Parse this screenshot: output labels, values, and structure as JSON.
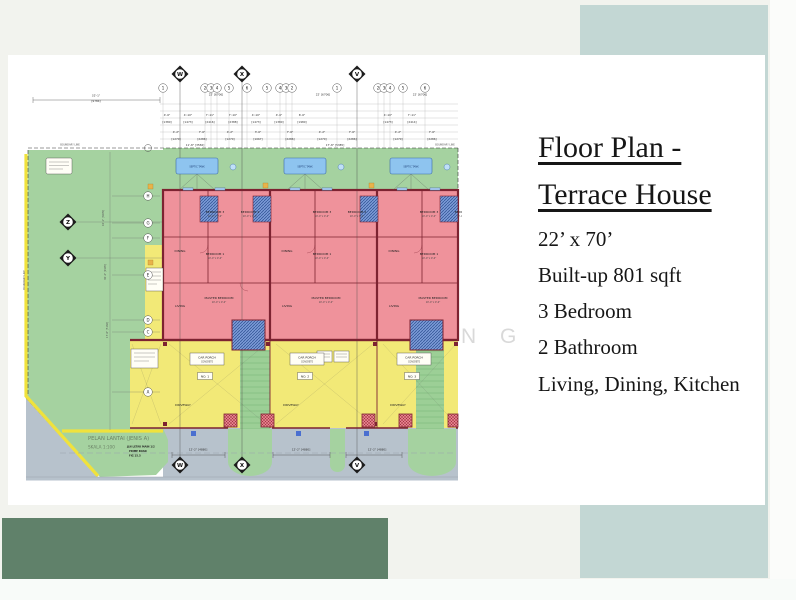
{
  "page": {
    "background": "#f2f3ee",
    "card_color": "#ffffff",
    "accent_band_color": "#c3d7d4",
    "bottom_block_color": "#60816a",
    "watermark_letters": [
      "N",
      "G"
    ]
  },
  "info_panel": {
    "title_line1": "Floor Plan -",
    "title_line2": "Terrace House",
    "specs": [
      "22’ x 70’",
      "Built-up 801 sqft",
      "3 Bedroom",
      "2 Bathroom",
      "Living, Dining, Kitchen"
    ]
  },
  "floor_plan": {
    "drawing_title": "PELAN LANTAI (JENIS A)",
    "drawing_scale": "SKALA 1:100",
    "drawing_notes": [
      "JLN LETAK MAIN 1/2",
      "PRIME ROAD",
      "FIG 15.5"
    ],
    "axis_top": [
      "W",
      "X",
      "V"
    ],
    "axis_side": [
      "Z",
      "Y"
    ],
    "grid_numbers": [
      "1",
      "2",
      "3",
      "4",
      "5",
      "6",
      "5",
      "4",
      "3",
      "2",
      "1",
      "2",
      "3",
      "4",
      "5",
      "6"
    ],
    "grid_row_letters": [
      "H",
      "G",
      "F",
      "E",
      "D",
      "C",
      "A"
    ],
    "labels": {
      "bedroom1": "BEDROOM 1",
      "bedroom2": "BEDROOM 2",
      "bedroom3": "BEDROOM 3",
      "master_bedroom": "MASTER BEDROOM",
      "living": "LIVING",
      "dining": "DINING",
      "room_size": "10'-0\" x 9'-0\"",
      "car_porch": "CAR PORCH",
      "car_porch_sub": "CONCRETE",
      "driveway": "DRIVEWAY",
      "septic_tank": "SEPTIC TANK",
      "boundary_line": "BOUNDARY LINE",
      "unit_nos": [
        "NO. 1",
        "NO. 2",
        "NO. 3"
      ]
    },
    "dims": {
      "overall_ft": "32'-1\"",
      "overall_mm": "[9784]",
      "unit_width": "22' [6706]",
      "road_dim": "12'-2\" [4880]",
      "yard": [
        "10'-1\" [3070]",
        "30'-2\" [9195]",
        "17'-0\" [5182]"
      ]
    },
    "colors": {
      "yard_green": "#a5d2a0",
      "house_pink": "#ef929b",
      "porch_yellow": "#f2e977",
      "road_gray": "#b7c2cc",
      "wall_red": "#7d2331",
      "tank_blue": "#8ec4ef",
      "bath_blue": "#7b9ad6"
    },
    "layout": {
      "top_bubbles_x": [
        163,
        205,
        211,
        217,
        229,
        247,
        267,
        280,
        286,
        292,
        337,
        378,
        384,
        390,
        403,
        425
      ],
      "left_bubbles_y": [
        196,
        223,
        238,
        275,
        320,
        332,
        392
      ],
      "lattice_y": [
        104,
        111,
        118,
        125,
        132,
        139
      ],
      "dim_rows": [
        {
          "y": 116,
          "x": [
            167,
            188,
            210,
            233,
            256,
            279,
            302,
            388,
            412
          ],
          "t": [
            "4'-6\"",
            "4'-10\"",
            "7'-11\"",
            "7'-10\"",
            "4'-10\"",
            "4'-6\"",
            "6'-6\"",
            "4'-10\"",
            "7'-11\""
          ]
        },
        {
          "y": 123,
          "x": [
            167,
            188,
            210,
            233,
            256,
            279,
            302,
            388,
            412
          ],
          "t": [
            "[1380]",
            "[1473]",
            "[2416]",
            "[2388]",
            "[1473]",
            "[1380]",
            "[1980]",
            "[1473]",
            "[2414]"
          ]
        },
        {
          "y": 133,
          "x": [
            176,
            202,
            230,
            258,
            290,
            322,
            352,
            398,
            432
          ],
          "t": [
            "4'-2\"",
            "7'-6\"",
            "4'-2\"",
            "3'-6\"",
            "7'-6\"",
            "4'-2\"",
            "7'-6\"",
            "4'-2\"",
            "7'-6\""
          ]
        },
        {
          "y": 140,
          "x": [
            176,
            202,
            230,
            258,
            290,
            322,
            352,
            398,
            432
          ],
          "t": [
            "[1270]",
            "[2286]",
            "[1270]",
            "[1067]",
            "[2286]",
            "[1270]",
            "[2286]",
            "[1270]",
            "[2286]"
          ]
        },
        {
          "y": 146,
          "x": [
            195,
            335
          ],
          "t": [
            "11'-8\" [3556]",
            "17'-8\" [5385]"
          ]
        }
      ],
      "unit_x0": [
        163,
        270,
        377
      ],
      "room_defs": [
        {
          "dx": 52,
          "dy": 213,
          "key": "bedroom3",
          "size": true
        },
        {
          "dx": 87,
          "dy": 213,
          "key": "bedroom2",
          "size": true
        },
        {
          "dx": 52,
          "dy": 255,
          "key": "bedroom1",
          "size": true
        },
        {
          "dx": 17,
          "dy": 252,
          "key": "dining",
          "size": false
        },
        {
          "dx": 56,
          "dy": 299,
          "key": "master_bedroom",
          "size": true
        },
        {
          "dx": 17,
          "dy": 307,
          "key": "living",
          "size": false
        }
      ],
      "porch_box_cx": [
        207,
        307,
        414
      ],
      "no_box_cx": [
        205,
        305,
        412
      ],
      "driveway_cx": [
        183,
        291,
        398
      ],
      "road_dim_cx": [
        198,
        301,
        377
      ],
      "septic_x": [
        176,
        284,
        390
      ],
      "markers_top": [
        {
          "x": 180,
          "y": 74
        },
        {
          "x": 242,
          "y": 74
        },
        {
          "x": 357,
          "y": 74
        }
      ],
      "markers_bottom": [
        {
          "x": 180,
          "y": 465
        },
        {
          "x": 242,
          "y": 465
        },
        {
          "x": 357,
          "y": 465
        }
      ],
      "markers_side": [
        {
          "x": 68,
          "y": 222
        },
        {
          "x": 68,
          "y": 258
        }
      ]
    }
  }
}
